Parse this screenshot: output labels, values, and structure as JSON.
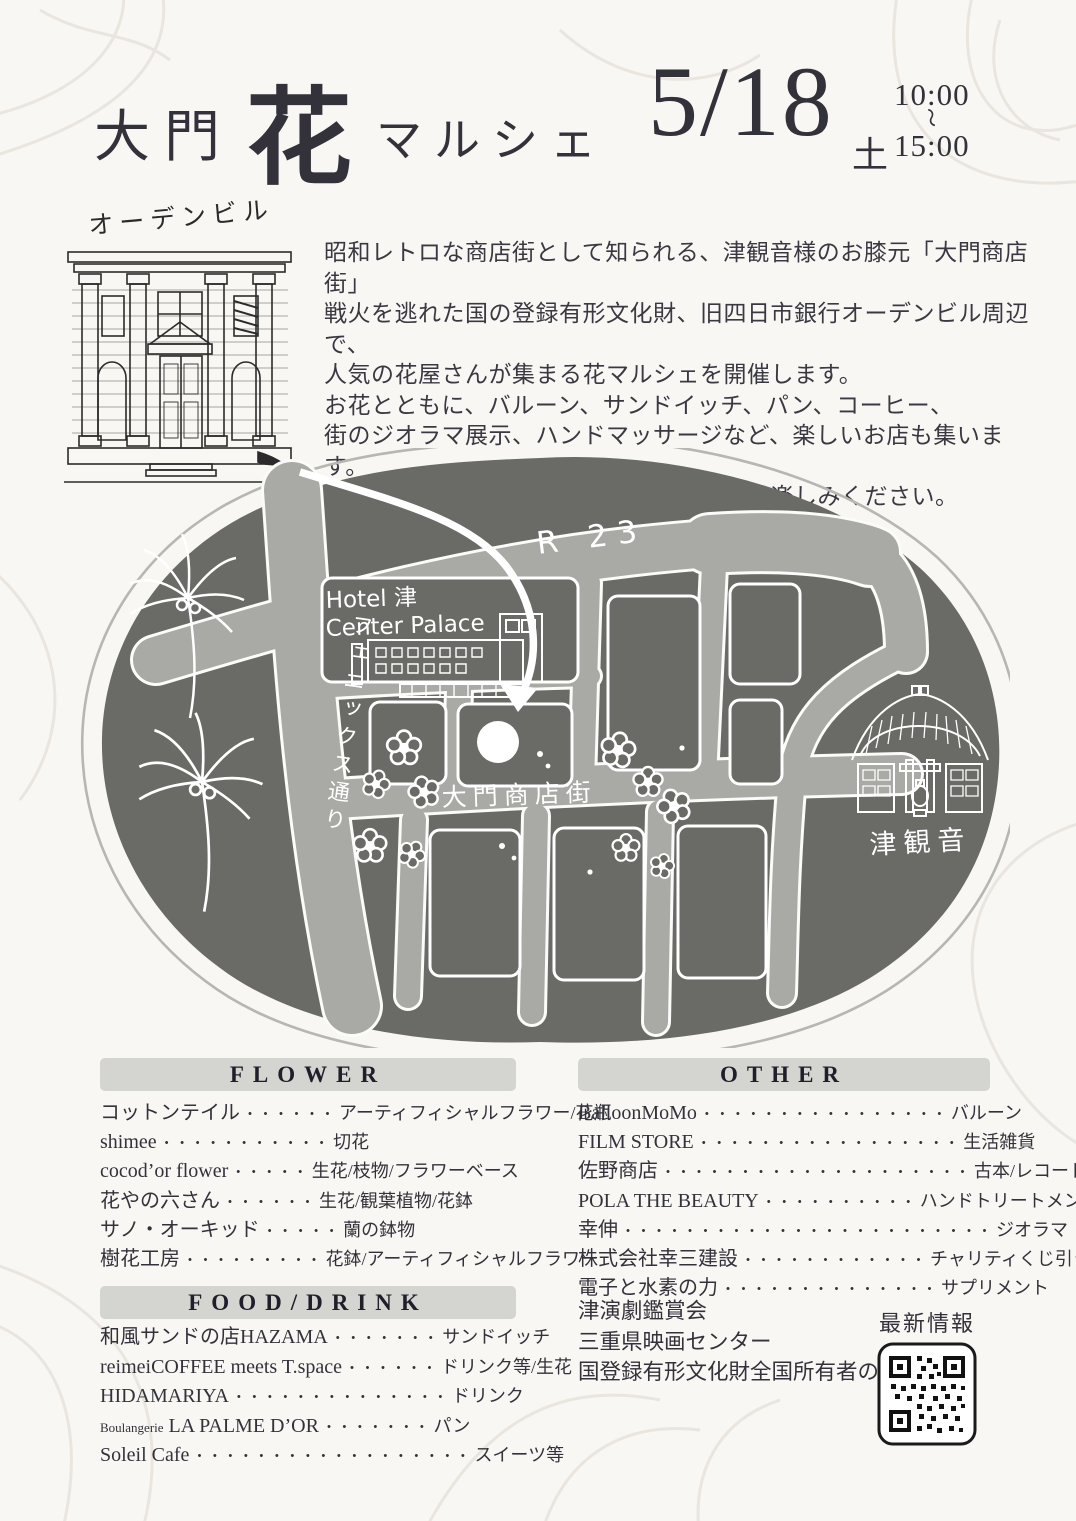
{
  "title": {
    "area": "大門",
    "hana": "花",
    "marche": "マルシェ",
    "date": "5/18",
    "day": "土",
    "time_start": "10:00",
    "tilde": "〜",
    "time_end": "15:00"
  },
  "building": {
    "label": "オーデンビル"
  },
  "intro": {
    "lines": [
      "昭和レトロな商店街として知られる、津観音様のお膝元「大門商店街」",
      "戦火を逃れた国の登録有形文化財、旧四日市銀行オーデンビル周辺で、",
      "人気の花屋さんが集まる花マルシェを開催します。",
      "お花とともに、バルーン、サンドイッチ、パン、コーヒー、",
      "街のジオラマ展示、ハンドマッサージなど、楽しいお店も集います。",
      "のんびり散歩がてら、懐かしい津の街をお楽しみください。"
    ]
  },
  "map": {
    "labels": {
      "hotel_line1": "Hotel 津",
      "hotel_line2": "Center Palace",
      "route": "R 23",
      "street": "大門商店街",
      "phoenix": "フェニックス通り",
      "temple": "津観音"
    }
  },
  "sections": {
    "flower": {
      "header": "FLOWER",
      "items": [
        {
          "name": "コットンテイル",
          "dots": "・・・・・・",
          "desc": "アーティフィシャルフラワー/花瓶"
        },
        {
          "name": "shimee",
          "dots": "・・・・・・・・・・・",
          "desc": "切花"
        },
        {
          "name": "cocod’or flower",
          "dots": "・・・・・",
          "desc": "生花/枝物/フラワーベース"
        },
        {
          "name": "花やの六さん",
          "dots": "・・・・・・",
          "desc": "生花/観葉植物/花鉢"
        },
        {
          "name": "サノ・オーキッド",
          "dots": "・・・・・",
          "desc": "蘭の鉢物"
        },
        {
          "name": "樹花工房",
          "dots": "・・・・・・・・・",
          "desc": "花鉢/アーティフィシャルフラワー"
        }
      ]
    },
    "food": {
      "header": "FOOD/DRINK",
      "items": [
        {
          "name": "和風サンドの店HAZAMA",
          "dots": "・・・・・・・",
          "desc": "サンドイッチ"
        },
        {
          "name": "reimeiCOFFEE meets T.space",
          "dots": "・・・・・・",
          "desc": "ドリンク等/生花"
        },
        {
          "name": "HIDAMARIYA",
          "dots": "・・・・・・・・・・・・・・",
          "desc": "ドリンク"
        },
        {
          "prefix": "Boulangerie",
          "name": "LA PALME D’OR",
          "dots": "・・・・・・・",
          "desc": "パン"
        },
        {
          "name": "Soleil Cafe",
          "dots": "・・・・・・・・・・・・・・・・・・",
          "desc": "スイーツ等"
        }
      ]
    },
    "other": {
      "header": "OTHER",
      "items": [
        {
          "name": "BalloonMoMo",
          "dots": "・・・・・・・・・・・・・・・・",
          "desc": "バルーン"
        },
        {
          "name": "FILM STORE",
          "dots": "・・・・・・・・・・・・・・・・・",
          "desc": "生活雑貨"
        },
        {
          "name": "佐野商店",
          "dots": "・・・・・・・・・・・・・・・・・・・・",
          "desc": "古本/レコード"
        },
        {
          "name": "POLA THE BEAUTY",
          "dots": "・・・・・・・・・・",
          "desc": "ハンドトリートメント"
        },
        {
          "name": "幸伸",
          "dots": "・・・・・・・・・・・・・・・・・・・・・・・・",
          "desc": "ジオラマ"
        },
        {
          "name": "株式会社幸三建設",
          "dots": "・・・・・・・・・・・・",
          "desc": "チャリティくじ引き"
        },
        {
          "name": "電子と水素の力",
          "dots": "・・・・・・・・・・・・・・",
          "desc": "サプリメント"
        }
      ]
    }
  },
  "supporters": {
    "lines": [
      "津演劇鑑賞会",
      "三重県映画センター",
      "国登録有形文化財全国所有者の会"
    ]
  },
  "qr": {
    "label": "最新情報"
  },
  "colors": {
    "page_bg": "#f8f7f4",
    "ink": "#33323a",
    "header_bar": "#d4d4d0",
    "map_dark": "#6a6a66",
    "map_road": "#a9a9a5",
    "map_line": "#ffffff"
  }
}
